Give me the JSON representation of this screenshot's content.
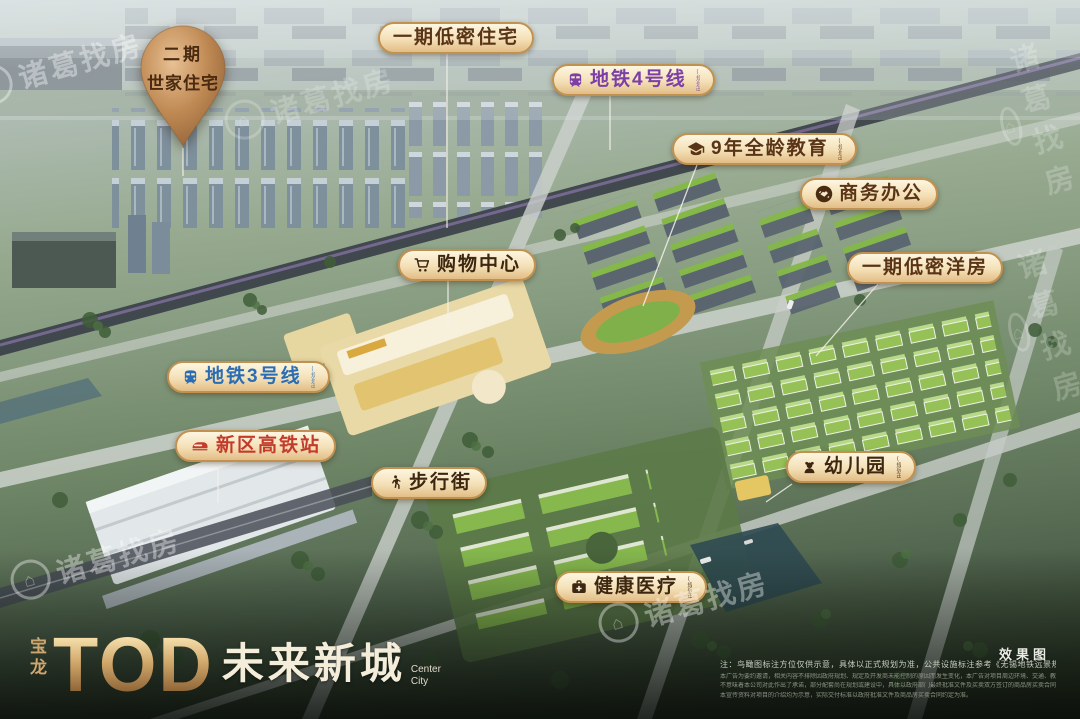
{
  "pin": {
    "line1": "二期",
    "line2": "世家住宅"
  },
  "labels": {
    "phase1_residence": {
      "text": "一期低密住宅"
    },
    "metro4": {
      "text": "地铁4号线",
      "suffix": "(规划中)"
    },
    "education": {
      "text": "9年全龄教育",
      "suffix": "(规划中)"
    },
    "office": {
      "text": "商务办公"
    },
    "phase1_houses": {
      "text": "一期低密洋房"
    },
    "mall": {
      "text": "购物中心"
    },
    "metro3": {
      "text": "地铁3号线",
      "suffix": "(规划中)"
    },
    "hsr": {
      "text": "新区高铁站"
    },
    "walkstreet": {
      "text": "步行街"
    },
    "kindergarten": {
      "text": "幼儿园",
      "suffix": "(规划中)"
    },
    "healthcare": {
      "text": "健康医疗",
      "suffix": "(规划中)"
    }
  },
  "logo": {
    "brand": "宝龙",
    "title": "TOD",
    "subtitle": "未来新城",
    "en_line1": "Center",
    "en_line2": "City"
  },
  "footer": {
    "render_tag": "效果图",
    "note": "注：鸟瞰图标注方位仅供示意，具体以正式规划为准，公共设施标注参考《无锡地铁远景规划图》。",
    "fine_print": [
      "本广告为要约邀请，相关内容不排除因政府规划、规定及开发商未能控制的原因而发生变化，本广告对项目周边环境、交通、教育及其他公共设施的介绍旨在提供相关信息。",
      "不意味着本公司对此作出了承诺，部分配套尚在规划或建设中，具体以政府部门最终批准文件及买卖双方签订的商品房买卖合同为准，敬请留意最新资料。",
      "本宣传资料对项目的介绍均为示意，实际交付标准以政府批准文件及商品房买卖合同约定为准。"
    ]
  },
  "watermark": {
    "text": "诸葛找房"
  },
  "colors": {
    "pill_background": "#f4e0b6",
    "pill_border": "#c2914f",
    "label_brown": "#5a3416",
    "metro4_purple": "#7b3fa5",
    "metro3_blue": "#2a6db5",
    "hsr_red": "#c23b2b",
    "pin_bronze": "#c08a54",
    "logo_gold": "#d2a96c"
  }
}
